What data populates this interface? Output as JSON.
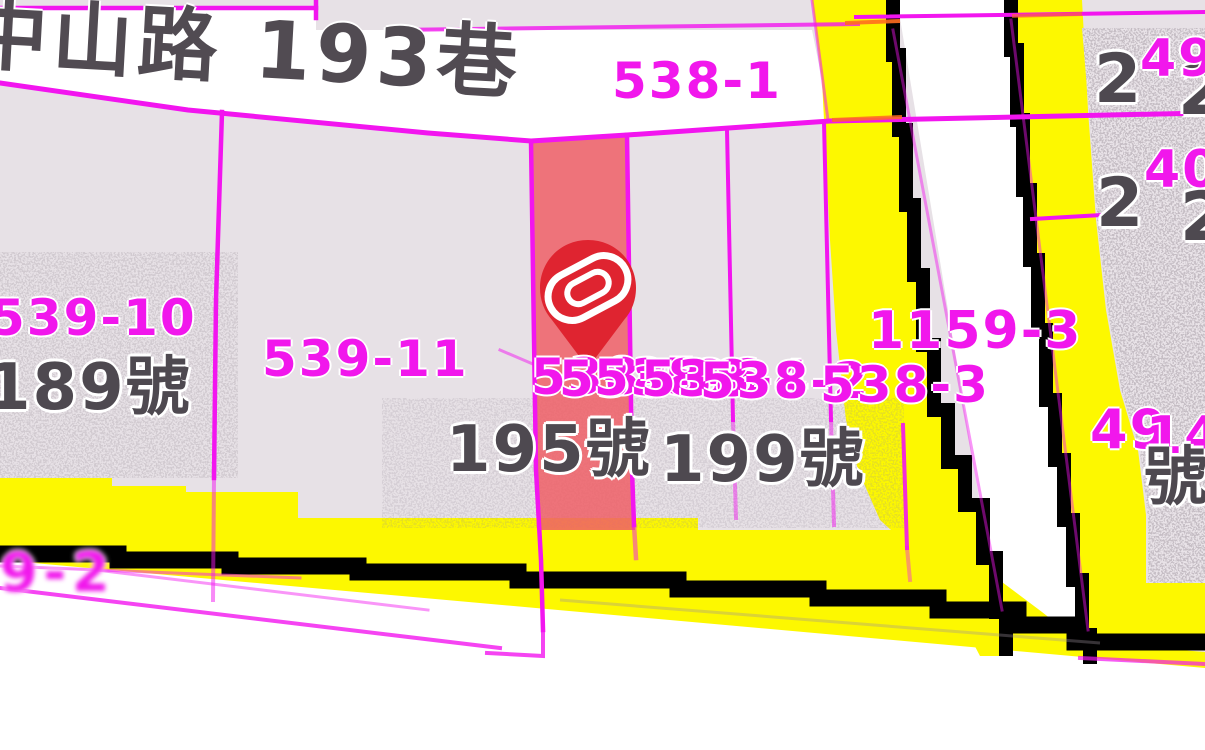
{
  "map": {
    "street_label": "中山路 193巷",
    "labels": {
      "p538_1": "538-1",
      "p539_10": "539-10",
      "p539_11": "539-11",
      "cluster": [
        "538-5",
        "538-8",
        "538-6",
        "538-4",
        "538-2",
        "538-3"
      ],
      "p1159_3": "1159-3",
      "h189": "189號",
      "h195": "195號",
      "h199": "199號",
      "rt2a": "2",
      "rt2a2": "2",
      "rt49": "49",
      "rt2b": "2",
      "rt2b2": "2",
      "rt40": "40",
      "rb49": "49",
      "rb14": "14",
      "rb_hao": "號",
      "bl_smear": "9-2"
    },
    "pin": {
      "icon": "location-pin-icon",
      "glyph": "spiral-ribbon-icon"
    },
    "colors": {
      "background": "#e7e1e6",
      "road_white": "#ffffff",
      "road_yellow": "#fdf800",
      "boundary_magenta": "#f117ec",
      "border_black": "#000000",
      "highlight_parcel": "#ee5f66",
      "pin_red": "#df2430",
      "text_dark": "#4e4950"
    }
  }
}
